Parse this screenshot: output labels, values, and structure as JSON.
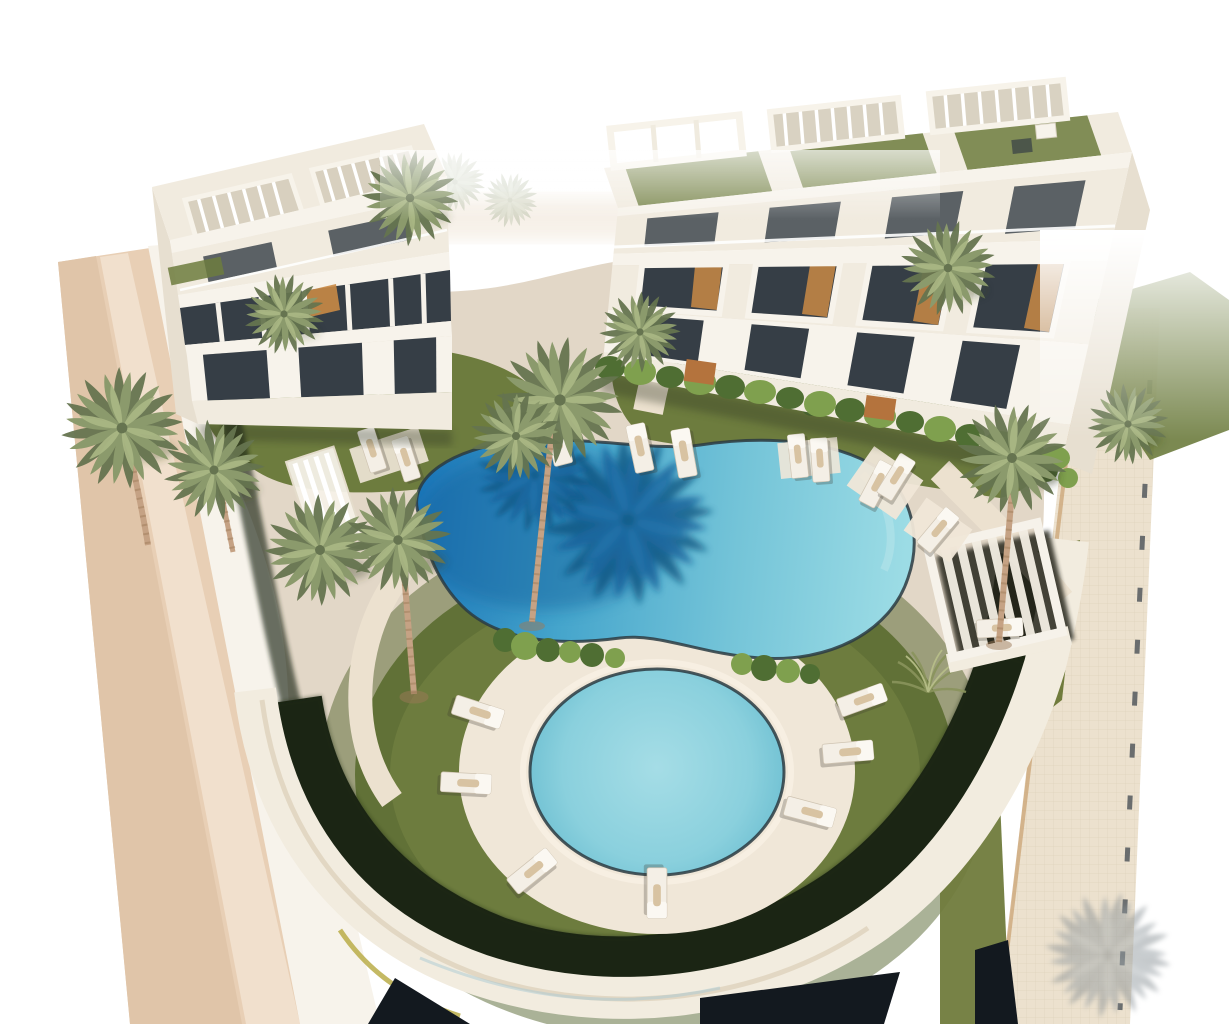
{
  "scene": {
    "type": "3d-architectural-render",
    "subject": "aerial view of a modern residential complex with two apartment buildings, communal pools, palm garden, road and sidewalk",
    "background": "#ffffff",
    "colors": {
      "background": "#ffffff",
      "road_base": "#e8cfb5",
      "road_dark": "#e0c5a9",
      "road_light": "#f1e0cd",
      "sidewalk": "#ece1ce",
      "sidewalk_line": "#dbcdb4",
      "curb_dark": "#4a5056",
      "curb_tan": "#c9a06f",
      "deck": "#e2d7c7",
      "deck_light": "#f0e7d8",
      "path": "#ece1cf",
      "grass": "#6d7c3e",
      "grass_light": "#7f8f4a",
      "grass_dark": "#55652f",
      "grass_shadow": "#1b2512",
      "lawn_olive": "#707b3c",
      "hedge": "#4f6e33",
      "hedge_light": "#7fa04e",
      "pool_deep": "#1a74b8",
      "pool_mid": "#45a5cc",
      "pool_light": "#9cdce5",
      "pool_shadow": "#13659f",
      "round_pool_light": "#a5dde6",
      "round_pool_deep": "#6fc0d2",
      "coping": "#2c3b42",
      "building_white": "#f7f3eb",
      "building_face": "#f1ebdf",
      "building_shade": "#e7dfd0",
      "glass": "#363e46",
      "glass_light": "#5a656f",
      "wood": "#b4733d",
      "stair_wood": "#c98a45",
      "pergola_shadow": "#26271e",
      "wall_band": "#f2ecdf",
      "wall_edge": "#d5c6ab",
      "wedge_dark": "#13191f",
      "accent_yellow": "#b5a83d",
      "shadow_grey": "#939ba0",
      "trunk": "#c5a284",
      "trunk_dark": "#9c7a57",
      "palm_light": "#abb885",
      "palm_mid": "#8b9a6c",
      "palm_dark": "#667450",
      "palm_faded": "#c2cab2"
    },
    "objects": [
      {
        "name": "apartment-building-left",
        "count": 1
      },
      {
        "name": "apartment-building-right",
        "count": 1
      },
      {
        "name": "rooftop-pergola",
        "count": 5
      },
      {
        "name": "garden-pergola",
        "count": 1
      },
      {
        "name": "main-pool",
        "count": 1
      },
      {
        "name": "round-pool",
        "count": 1
      },
      {
        "name": "sun-lounger",
        "count": 18
      },
      {
        "name": "palm-tree",
        "count": 15
      },
      {
        "name": "hedge-row",
        "count": 1
      },
      {
        "name": "wooden-gate",
        "count": 2
      },
      {
        "name": "road",
        "count": 1
      },
      {
        "name": "sidewalk",
        "count": 1
      },
      {
        "name": "lawn",
        "count": 1
      },
      {
        "name": "perimeter-wall",
        "count": 1
      }
    ]
  }
}
